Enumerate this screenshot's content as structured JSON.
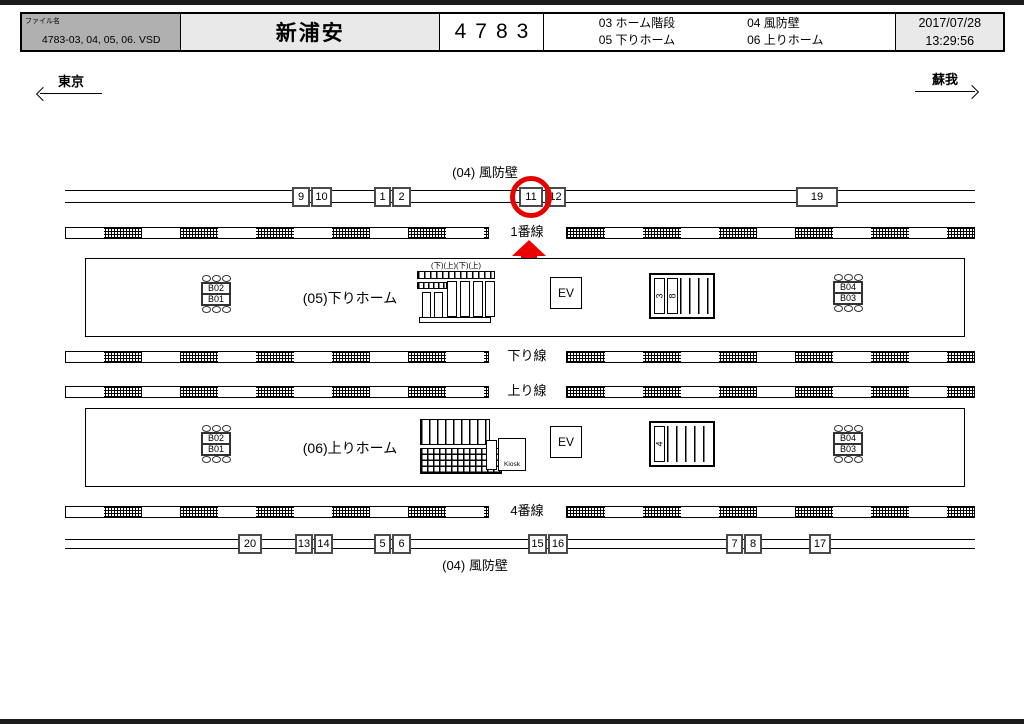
{
  "header": {
    "file_label": "ファイル名",
    "file_name": "4783-03, 04, 05, 06. VSD",
    "station_name": "新浦安",
    "station_code": "4783",
    "legend": [
      "03 ホーム階段",
      "04 風防壁",
      "05 下りホーム",
      "06 上りホーム"
    ],
    "date": "2017/07/28",
    "time": "13:29:56"
  },
  "directions": {
    "left_label": "東京",
    "right_label": "蘇我"
  },
  "walls": {
    "top_label": "(04) 風防壁",
    "bottom_label": "(04) 風防壁",
    "top_boxes": [
      {
        "label": "9",
        "x": 292,
        "w": 18
      },
      {
        "label": "10",
        "x": 311,
        "w": 21
      },
      {
        "label": "1",
        "x": 374,
        "w": 17
      },
      {
        "label": "2",
        "x": 392,
        "w": 19
      },
      {
        "label": "11",
        "x": 519,
        "w": 24,
        "highlight": true
      },
      {
        "label": "12",
        "x": 545,
        "w": 21
      },
      {
        "label": "19",
        "x": 796,
        "w": 42
      }
    ],
    "bottom_boxes": [
      {
        "label": "20",
        "x": 238,
        "w": 24
      },
      {
        "label": "13",
        "x": 295,
        "w": 18
      },
      {
        "label": "14",
        "x": 314,
        "w": 19
      },
      {
        "label": "5",
        "x": 374,
        "w": 17
      },
      {
        "label": "6",
        "x": 392,
        "w": 19
      },
      {
        "label": "15",
        "x": 528,
        "w": 19
      },
      {
        "label": "16",
        "x": 548,
        "w": 20
      },
      {
        "label": "7",
        "x": 726,
        "w": 17
      },
      {
        "label": "8",
        "x": 744,
        "w": 18
      },
      {
        "label": "17",
        "x": 809,
        "w": 22
      }
    ]
  },
  "tracks": [
    {
      "label": "1番線",
      "y": 227
    },
    {
      "label": "下り線",
      "y": 351
    },
    {
      "label": "上り線",
      "y": 386
    },
    {
      "label": "4番線",
      "y": 506
    }
  ],
  "platforms": {
    "down": {
      "label": "(05)下りホーム",
      "bench_left": [
        "B02",
        "B01"
      ],
      "bench_right": [
        "B04",
        "B03"
      ],
      "elevator": "EV",
      "escalator_header": "(下)(上)(下)(上)",
      "stair_labels": [
        "3",
        "8"
      ]
    },
    "up": {
      "label": "(06)上りホーム",
      "bench_left": [
        "B02",
        "B01"
      ],
      "bench_right": [
        "B04",
        "B03"
      ],
      "elevator": "EV",
      "kiosk_label": "Kiosk",
      "stair_labels": [
        "4"
      ]
    }
  },
  "highlight": {
    "circled_box": "11",
    "color": "#e60000"
  }
}
